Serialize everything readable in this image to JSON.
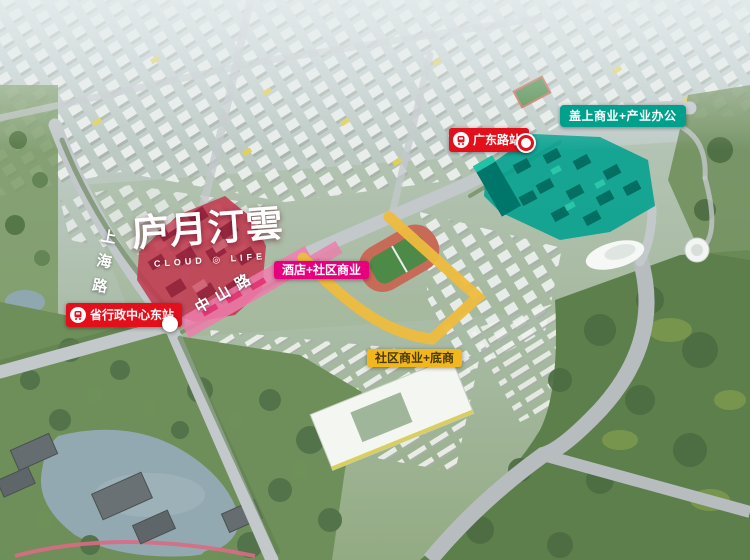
{
  "project": {
    "name_cn": "庐月汀雲",
    "name_en": "CLOUD ◎ LIFE"
  },
  "roads": {
    "shanghai_road": "上海路",
    "zhongshan_road": "中山路"
  },
  "badges": {
    "station_guangdong": {
      "label": "广东路站",
      "icon": "metro-icon",
      "color": "#e3101c"
    },
    "station_admin_center": {
      "label": "省行政中心东站",
      "icon": "metro-icon",
      "color": "#e3101c"
    },
    "podium_commerce_office": {
      "label": "盖上商业+产业办公",
      "color": "#00a08c"
    },
    "hotel_community_commerce": {
      "label": "酒店+社区商业",
      "color": "#e6007e"
    },
    "community_commerce_shops": {
      "label": "社区商业+底商",
      "color": "#f1b71c",
      "text_color": "#4a3a05"
    }
  },
  "areas": {
    "project_site_color": "#c23a50",
    "podium_block_color": "#00a18e",
    "highlight_road_color": "#eebc3e",
    "street_retail_strip_color": "#ee7cab"
  }
}
